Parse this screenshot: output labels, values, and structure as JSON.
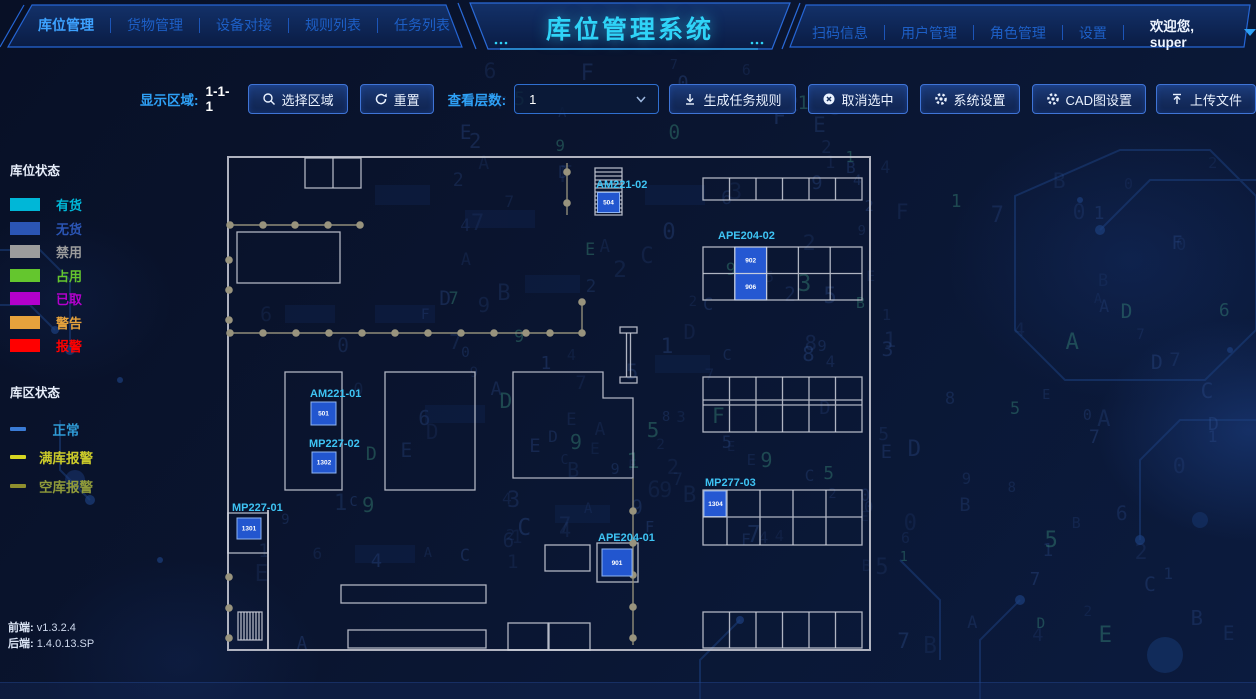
{
  "header": {
    "title": "库位管理系统",
    "nav_left": [
      {
        "label": "库位管理",
        "active": true
      },
      {
        "label": "货物管理",
        "active": false
      },
      {
        "label": "设备对接",
        "active": false
      },
      {
        "label": "规则列表",
        "active": false
      },
      {
        "label": "任务列表",
        "active": false
      }
    ],
    "nav_right": [
      {
        "label": "扫码信息"
      },
      {
        "label": "用户管理"
      },
      {
        "label": "角色管理"
      },
      {
        "label": "设置"
      }
    ],
    "welcome": "欢迎您, super"
  },
  "toolbar": {
    "display_area_label": "显示区域:",
    "display_area_value": "1-1-1",
    "select_area_button": "选择区域",
    "reset_button": "重置",
    "layers_label": "查看层数:",
    "layers_value": "1",
    "buttons": [
      {
        "label": "生成任务规则",
        "icon": "generate-rules-icon"
      },
      {
        "label": "取消选中",
        "icon": "cancel-icon"
      },
      {
        "label": "系统设置",
        "icon": "gear-icon"
      },
      {
        "label": "CAD图设置",
        "icon": "gear-icon"
      },
      {
        "label": "上传文件",
        "icon": "upload-icon"
      }
    ]
  },
  "legend": {
    "location_status_title": "库位状态",
    "location_statuses": [
      {
        "label": "有货",
        "color": "#00b7d7"
      },
      {
        "label": "无货",
        "color": "#2b55b4"
      },
      {
        "label": "禁用",
        "color": "#9c9c9c"
      },
      {
        "label": "占用",
        "color": "#64c62e"
      },
      {
        "label": "已取",
        "color": "#b300cc"
      },
      {
        "label": "警告",
        "color": "#e6a23c"
      },
      {
        "label": "报警",
        "color": "#ff0000"
      }
    ],
    "area_status_title": "库区状态",
    "area_statuses": [
      {
        "label": "正常",
        "color": "#2f9bd6",
        "line_color": "#3a7bd5"
      },
      {
        "label": "满库报警",
        "color": "#cbcb2a",
        "line_color": "#d6d622"
      },
      {
        "label": "空库报警",
        "color": "#8f9a3a",
        "line_color": "#8f8f2e"
      }
    ]
  },
  "versions": {
    "frontend_label": "前端:",
    "frontend": "v1.3.2.4",
    "backend_label": "后端:",
    "backend": "1.4.0.13.SP"
  },
  "map": {
    "locations": [
      {
        "id": "AM221-02",
        "values": [
          "504"
        ]
      },
      {
        "id": "APE204-02",
        "values": [
          "902",
          "906"
        ]
      },
      {
        "id": "AM221-01",
        "values": [
          "501"
        ]
      },
      {
        "id": "MP227-02",
        "values": [
          "1302"
        ]
      },
      {
        "id": "MP227-01",
        "values": [
          "1301"
        ]
      },
      {
        "id": "MP277-03",
        "values": [
          "1304"
        ]
      },
      {
        "id": "APE204-01",
        "values": [
          "901"
        ]
      }
    ]
  },
  "icons": [
    "search-icon",
    "refresh-icon",
    "chevron-down-icon",
    "generate-rules-icon",
    "cancel-icon",
    "gear-icon",
    "upload-icon",
    "user-dropdown-caret"
  ],
  "colors": {
    "accent_cyan": "#2fd3f7",
    "nav_active": "#3da2ff",
    "nav_inactive": "#1d5fc6",
    "button_border": "#3f74d6",
    "toolbar_label": "#2ea0f5",
    "map_label": "#3ec4f4",
    "map_location_fill": "#2256cf"
  },
  "background": {
    "matrix_chars": "0123456789ABCDEF"
  }
}
